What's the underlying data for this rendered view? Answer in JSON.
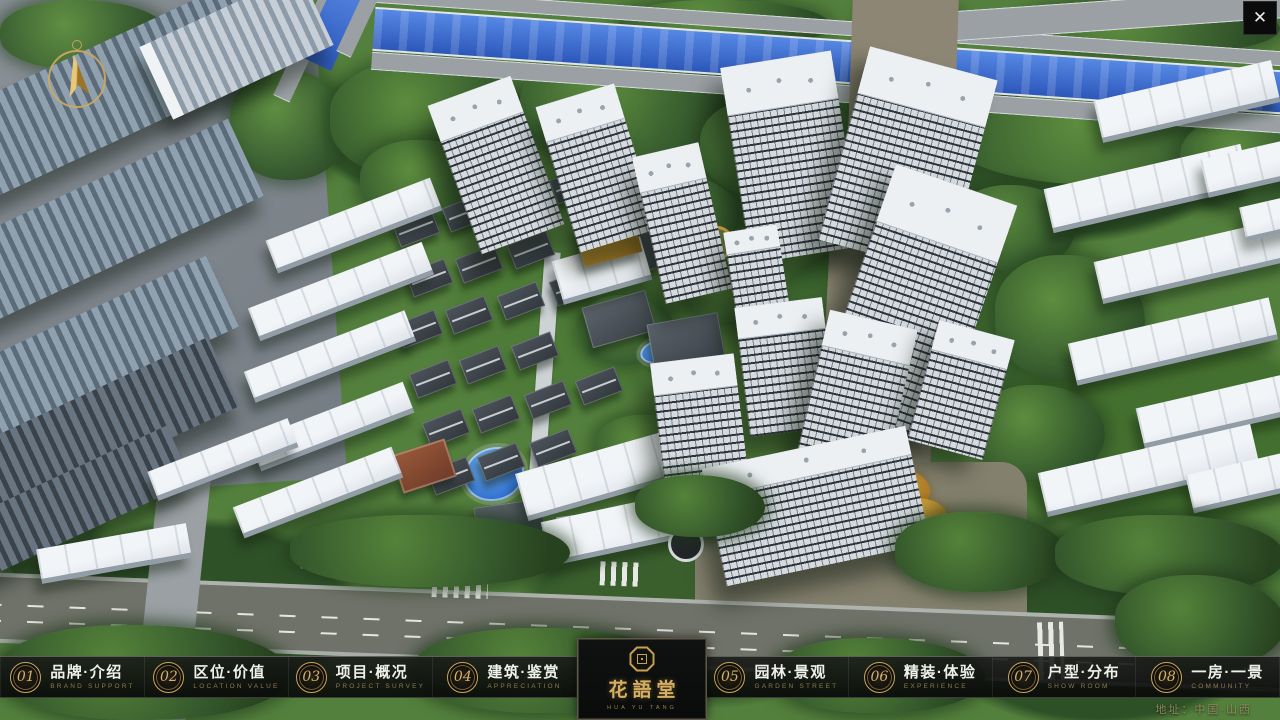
{
  "window": {
    "title": "residential-masterplan-presentation"
  },
  "icons": {
    "close_icon": "✕",
    "compass_icon": "gold-north-arrow",
    "logo_seal_icon": "octagon-seal"
  },
  "logo": {
    "title": "花語堂",
    "subtitle": "HUA YU TANG"
  },
  "nav": {
    "items": [
      {
        "num": "01",
        "title": "品牌·介绍",
        "subtitle": "BRAND SUPPORT"
      },
      {
        "num": "02",
        "title": "区位·价值",
        "subtitle": "LOCATION VALUE"
      },
      {
        "num": "03",
        "title": "项目·概况",
        "subtitle": "PROJECT SURVEY"
      },
      {
        "num": "04",
        "title": "建筑·鉴赏",
        "subtitle": "APPRECIATION"
      },
      {
        "num": "05",
        "title": "园林·景观",
        "subtitle": "GARDEN STREET"
      },
      {
        "num": "06",
        "title": "精装·体验",
        "subtitle": "EXPERIENCE"
      },
      {
        "num": "07",
        "title": "户型·分布",
        "subtitle": "SHOW ROOM"
      },
      {
        "num": "08",
        "title": "一房·一景",
        "subtitle": "COMMUNITY"
      }
    ]
  },
  "footer": {
    "address": "地址：中国·山西"
  },
  "colors": {
    "gold_accent": "#c9a35b",
    "navbar_bg": "rgba(13,14,12,0.88)",
    "river_blue": "#3a6bd0",
    "title_text": "#eef0ea",
    "subtitle_gold": "#8d7b4c"
  }
}
